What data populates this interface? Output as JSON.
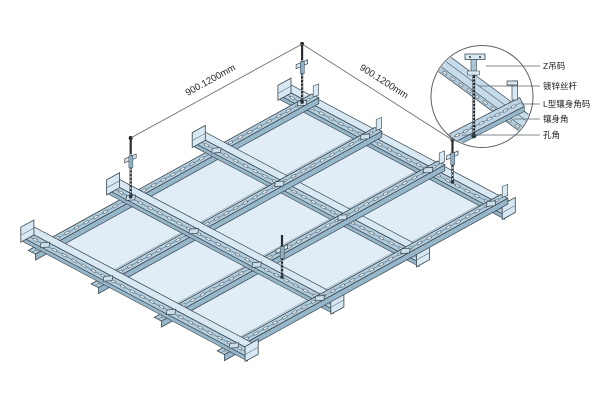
{
  "diagram": {
    "dimension_left": "900.1200mm",
    "dimension_right": "900.1200mm",
    "callouts": [
      "Z吊码",
      "镀锌丝杆",
      "L型镶身角码",
      "镶身角",
      "孔角"
    ]
  },
  "colors": {
    "background": "#ffffff",
    "panel_fill": "#d5e5f0",
    "panel_inner": "#e1edf6",
    "rail_fill": "#b2cddd",
    "rail_light": "#d9e9f3",
    "rail_web": "#96b6ca",
    "connector": "#cadeec",
    "outline": "#38444d",
    "line": "#5a6168",
    "dim_line": "#6a7077",
    "text": "#1d2226",
    "hole_light": "#edf4f9",
    "hole_dark": "#4c5c68",
    "rod": "#262e34",
    "band_fill": "#c6dcea",
    "band_lower": "#b3ccdc",
    "detail_rail": "#bdd4e4"
  }
}
